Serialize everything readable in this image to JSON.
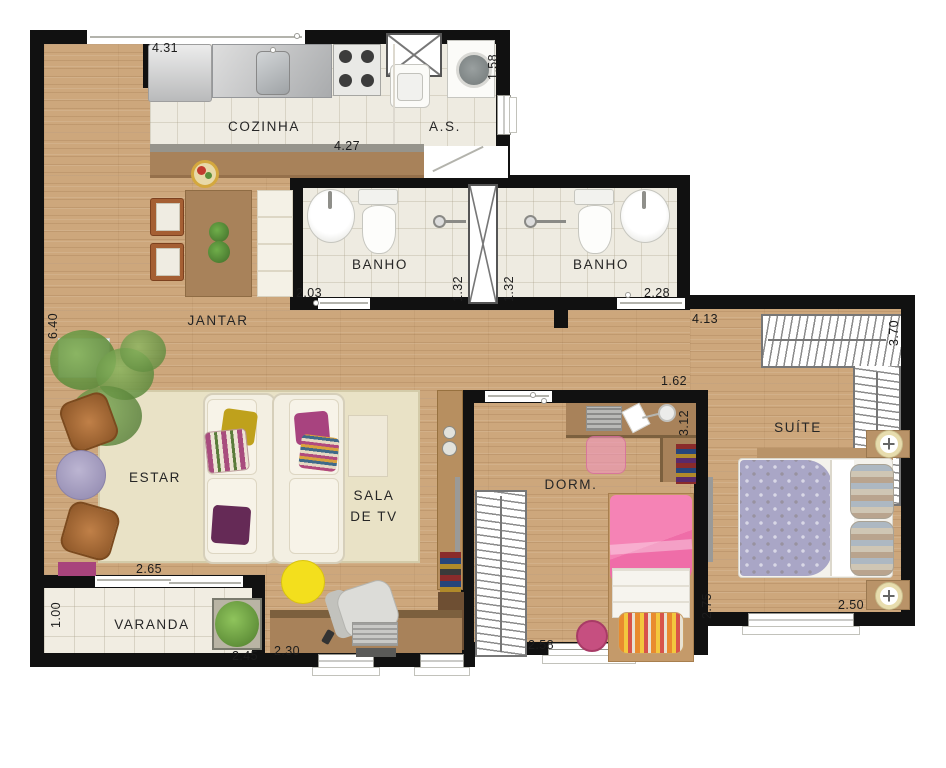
{
  "rooms": {
    "cozinha": "COZINHA",
    "as": "A.S.",
    "banho1": "BANHO",
    "banho2": "BANHO",
    "jantar": "JANTAR",
    "estar": "ESTAR",
    "sala_tv": "SALA\nDE TV",
    "varanda": "VARANDA",
    "dorm": "DORM.",
    "suite": "SUÍTE"
  },
  "dims": {
    "d431": "4.31",
    "d158": "1.58",
    "d427": "4.27",
    "d203": "2.03",
    "d132a": "1.32",
    "d132b": "1.32",
    "d228": "2.28",
    "d640": "6.40",
    "d413": "4.13",
    "d370": "3.70",
    "d162": "1.62",
    "d312": "3.12",
    "d265": "2.65",
    "d100": "1.00",
    "d245": "2.45",
    "d230": "2.30",
    "d258": "2.58",
    "d275": "2.75",
    "d250": "2.50"
  },
  "colors": {
    "wall": "#111111",
    "wood": "#cda77c",
    "tile": "#eeebe1",
    "varanda_tile": "#f1ede2",
    "rug": "#e9e2c6",
    "counter_wood": "#a8825a",
    "sofa": "#f3efe2",
    "pink": "#ef6da8",
    "magenta": "#b44a8c",
    "yellow": "#f3df1d",
    "purple": "#652a56",
    "mustard": "#bfa11c",
    "lavender": "#aaa3c2",
    "barrel": "#b06f3c",
    "plant": "#5f9a3d",
    "text": "#222222"
  }
}
